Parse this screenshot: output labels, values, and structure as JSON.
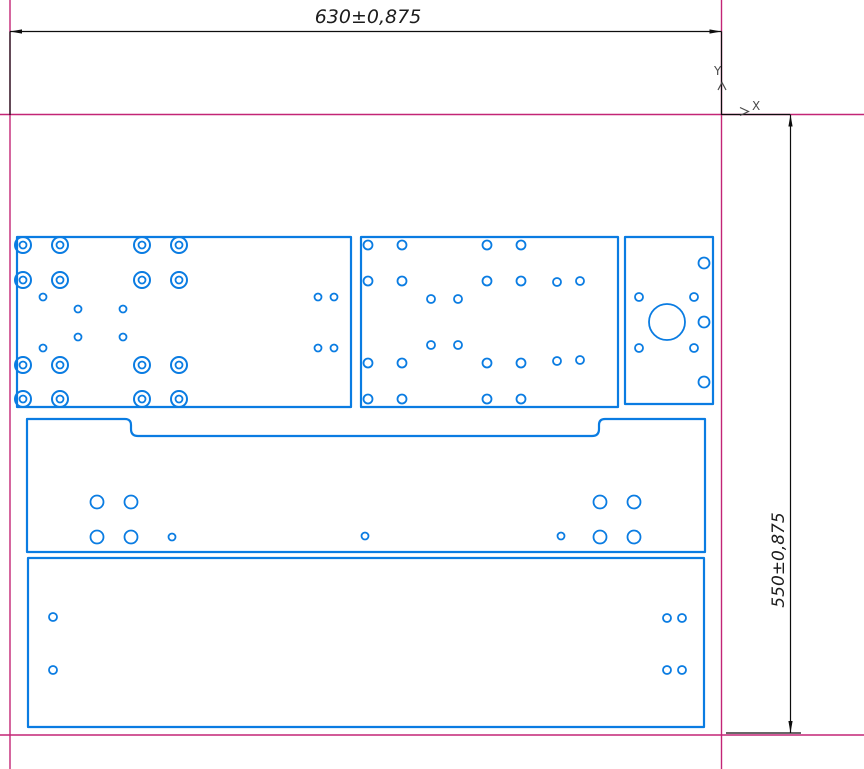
{
  "app": {
    "background": "#ffffff"
  },
  "colors": {
    "part_outline": "#0a7ce2",
    "sheet_boundary": "#c32576",
    "dimension": "#0d0d0d",
    "label_text": "#1c1c1c",
    "axis_text": "#4a4a4a"
  },
  "dimensions": {
    "width_label": "630±0,875",
    "height_label": "550±0,875"
  },
  "axis": {
    "x_label": "X",
    "y_label": "Y"
  },
  "geometry": {
    "sheet_lines": [
      [
        10,
        0,
        10,
        769
      ],
      [
        721.5,
        0,
        721.5,
        769
      ],
      [
        0,
        114.5,
        864,
        114.5
      ],
      [
        0,
        735,
        864,
        735
      ]
    ],
    "dim_lines": [
      [
        10,
        31.5,
        721.5,
        31.5
      ],
      [
        10,
        31.5,
        10,
        115
      ],
      [
        721.5,
        31.5,
        721.5,
        115
      ],
      [
        722,
        114.5,
        790,
        114.5
      ],
      [
        790.5,
        114.5,
        790.5,
        733
      ],
      [
        726,
        733,
        801,
        733
      ]
    ],
    "dim_arrows": [
      "10,31.5 22,29.4 22,33.6",
      "721.5,31.5 709.5,29.4 709.5,33.6",
      "790.5,114.5 788.4,126.5 792.6,126.5",
      "790.5,733 788.4,721 792.6,721"
    ],
    "axis_arrows": [
      "718,90 722,82.5 726,90",
      "740,107.5 748.5,111.5 740,115.5"
    ],
    "parts": [
      {
        "name": "plate-top-left",
        "rect": [
          17,
          237,
          334,
          170
        ],
        "double_holes": [
          [
            23,
            245,
            8,
            3.5
          ],
          [
            60,
            245,
            8,
            3.5
          ],
          [
            142,
            245,
            8,
            3.5
          ],
          [
            179,
            245,
            8,
            3.5
          ],
          [
            23,
            280,
            8,
            3.5
          ],
          [
            60,
            280,
            8,
            3.5
          ],
          [
            142,
            280,
            8,
            3.5
          ],
          [
            179,
            280,
            8,
            3.5
          ],
          [
            23,
            365,
            8,
            3.5
          ],
          [
            60,
            365,
            8,
            3.5
          ],
          [
            142,
            365,
            8,
            3.5
          ],
          [
            179,
            365,
            8,
            3.5
          ],
          [
            23,
            399,
            8,
            3.5
          ],
          [
            60,
            399,
            8,
            3.5
          ],
          [
            142,
            399,
            8,
            3.5
          ],
          [
            179,
            399,
            8,
            3.5
          ]
        ],
        "holes": [
          [
            43,
            297,
            3.5
          ],
          [
            78,
            309,
            3.5
          ],
          [
            123,
            309,
            3.5
          ],
          [
            43,
            348,
            3.5
          ],
          [
            78,
            337,
            3.5
          ],
          [
            123,
            337,
            3.5
          ],
          [
            318,
            297,
            3.5
          ],
          [
            334,
            297,
            3.5
          ],
          [
            318,
            348,
            3.5
          ],
          [
            334,
            348,
            3.5
          ]
        ]
      },
      {
        "name": "plate-top-middle",
        "rect": [
          361,
          237,
          257,
          170
        ],
        "holes": [
          [
            368,
            245,
            4.5
          ],
          [
            402,
            245,
            4.5
          ],
          [
            487,
            245,
            4.5
          ],
          [
            521,
            245,
            4.5
          ],
          [
            368,
            281,
            4.5
          ],
          [
            402,
            281,
            4.5
          ],
          [
            487,
            281,
            4.5
          ],
          [
            521,
            281,
            4.5
          ],
          [
            368,
            363,
            4.5
          ],
          [
            402,
            363,
            4.5
          ],
          [
            487,
            363,
            4.5
          ],
          [
            521,
            363,
            4.5
          ],
          [
            368,
            399,
            4.5
          ],
          [
            402,
            399,
            4.5
          ],
          [
            487,
            399,
            4.5
          ],
          [
            521,
            399,
            4.5
          ],
          [
            557,
            282,
            4
          ],
          [
            580,
            281,
            4
          ],
          [
            557,
            361,
            4
          ],
          [
            580,
            360,
            4
          ],
          [
            431,
            299,
            4
          ],
          [
            458,
            299,
            4
          ],
          [
            431,
            345,
            4
          ],
          [
            458,
            345,
            4
          ]
        ]
      },
      {
        "name": "plate-top-right",
        "rect": [
          625,
          237,
          88,
          167
        ],
        "holes": [
          [
            667,
            322,
            18
          ],
          [
            704,
            263,
            5.5
          ],
          [
            704,
            322,
            5.5
          ],
          [
            704,
            382,
            5.5
          ],
          [
            639,
            297,
            4
          ],
          [
            694,
            297,
            4
          ],
          [
            639,
            348,
            4
          ],
          [
            694,
            348,
            4
          ]
        ]
      },
      {
        "name": "plate-middle-notched",
        "path": "M27,419 L125,419 Q131,419 131,425 L131,429 Q131,436 138,436 L592,436 Q599,436 599,429 L599,425 Q599,419 605,419 L705,419 L705,552 L27,552 Z",
        "holes": [
          [
            97,
            502,
            6.5
          ],
          [
            131,
            502,
            6.5
          ],
          [
            97,
            537,
            6.5
          ],
          [
            131,
            537,
            6.5
          ],
          [
            600,
            502,
            6.5
          ],
          [
            634,
            502,
            6.5
          ],
          [
            600,
            537,
            6.5
          ],
          [
            634,
            537,
            6.5
          ],
          [
            172,
            537,
            3.5
          ],
          [
            365,
            536,
            3.5
          ],
          [
            561,
            536,
            3.5
          ]
        ]
      },
      {
        "name": "plate-bottom",
        "rect": [
          28,
          558,
          676,
          169
        ],
        "holes": [
          [
            53,
            617,
            4
          ],
          [
            53,
            670,
            4
          ],
          [
            667,
            618,
            4
          ],
          [
            682,
            618,
            4
          ],
          [
            667,
            670,
            4
          ],
          [
            682,
            670,
            4
          ]
        ]
      }
    ]
  }
}
